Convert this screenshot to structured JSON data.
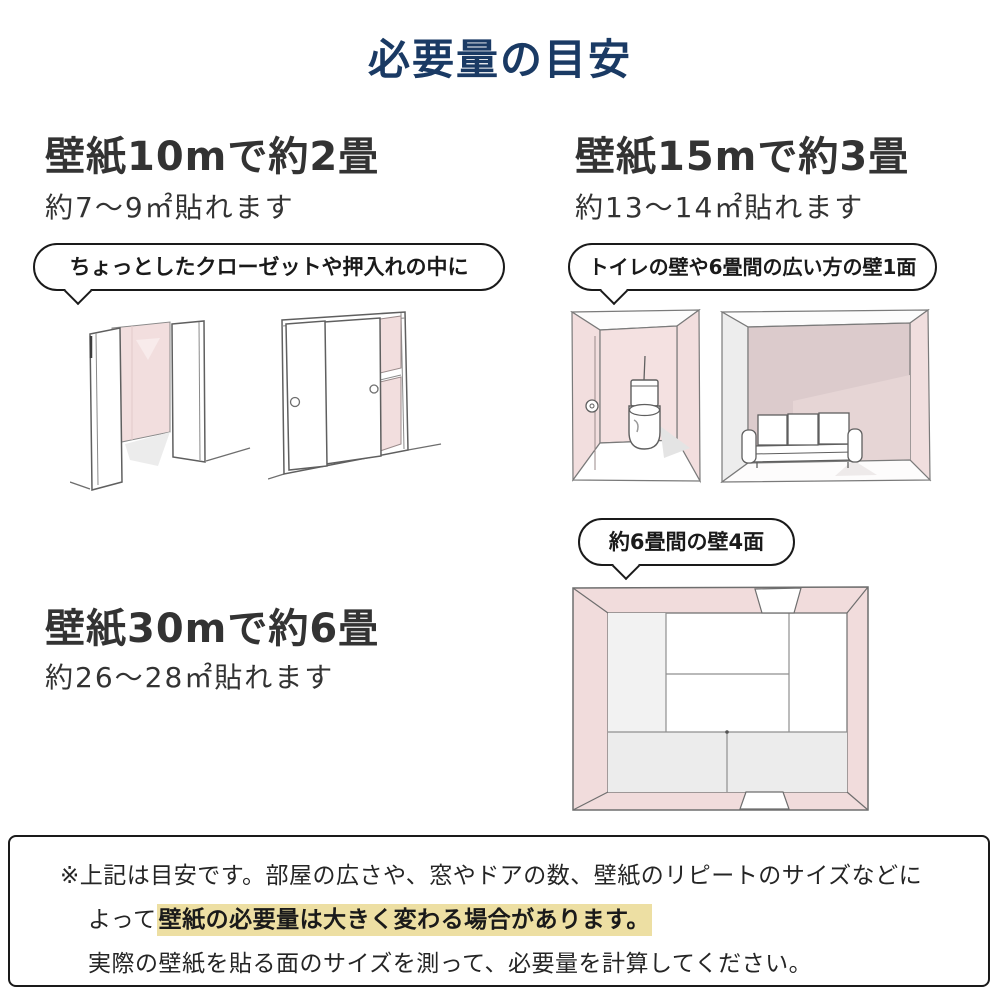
{
  "title": "必要量の目安",
  "colors": {
    "title_navy": "#1a3a64",
    "text_dark": "#333333",
    "wall_pink": "#f2dede",
    "wall_pink_dark": "#dccbcc",
    "wall_gray": "#ededed",
    "highlight_yellow": "#eddfa3",
    "line_black": "#1a1a1a"
  },
  "sections": {
    "m10": {
      "heading": "壁紙10mで約2畳",
      "coverage": "約7〜9㎡貼れます",
      "bubble": "ちょっとしたクローゼットや押入れの中に"
    },
    "m15": {
      "heading": "壁紙15mで約3畳",
      "coverage": "約13〜14㎡貼れます",
      "bubble": "トイレの壁や6畳間の広い方の壁1面"
    },
    "m30": {
      "heading": "壁紙30mで約6畳",
      "coverage": "約26〜28㎡貼れます",
      "bubble": "約6畳間の壁4面"
    }
  },
  "note": {
    "line1": "※上記は目安です。部屋の広さや、窓やドアの数、壁紙のリピートのサイズなどに",
    "line2_prefix": "よって",
    "line2_highlight": "壁紙の必要量は大きく変わる場合があります。",
    "line3": "実際の壁紙を貼る面のサイズを測って、必要量を計算してください。"
  }
}
